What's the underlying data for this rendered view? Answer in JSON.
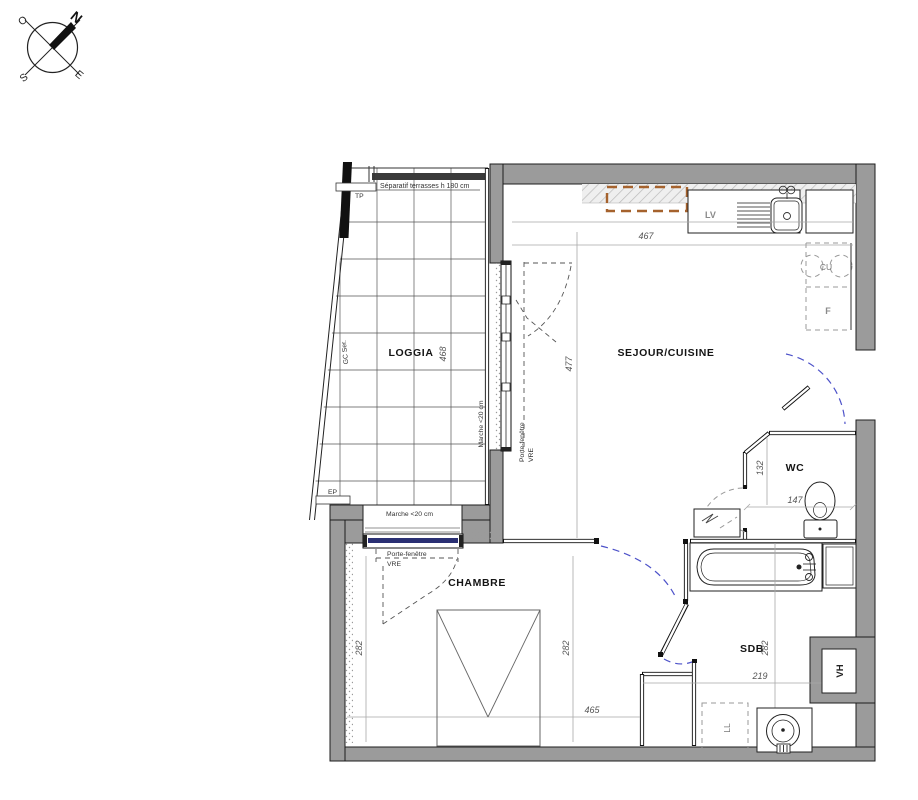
{
  "compass": {
    "n": "N",
    "o": "O",
    "s": "S",
    "e": "E"
  },
  "annotations": {
    "porte_fenetre": "Porte-fenêtre",
    "vre": "VRE",
    "marche": "Marche <20 cm",
    "separatif": "Séparatif terrasses h 180 cm"
  },
  "rooms": {
    "loggia": {
      "label": "LOGGIA",
      "dim": "468",
      "gc_ser": "GC Ser.",
      "tp": "TP",
      "ep": "EP"
    },
    "sejour": {
      "label": "SEJOUR/CUISINE",
      "dim_w": "467",
      "dim_h": "477",
      "lv": "LV",
      "cu": "CU",
      "f": "F"
    },
    "wc": {
      "label": "WC",
      "dim_w": "147",
      "dim_h": "132"
    },
    "chambre": {
      "label": "CHAMBRE",
      "dim_left": "282",
      "dim_right": "282",
      "dim_w": "465"
    },
    "sdb": {
      "label": "SDB",
      "dim_w": "219",
      "dim_h": "282",
      "ll": "LL",
      "vh": "VH"
    }
  },
  "colors": {
    "wall_gray": "#9b9b9b",
    "door_swing_blue": "#4d52c9",
    "cabinet_brown": "#a5622d",
    "glazing_navy": "#2a2f73"
  }
}
